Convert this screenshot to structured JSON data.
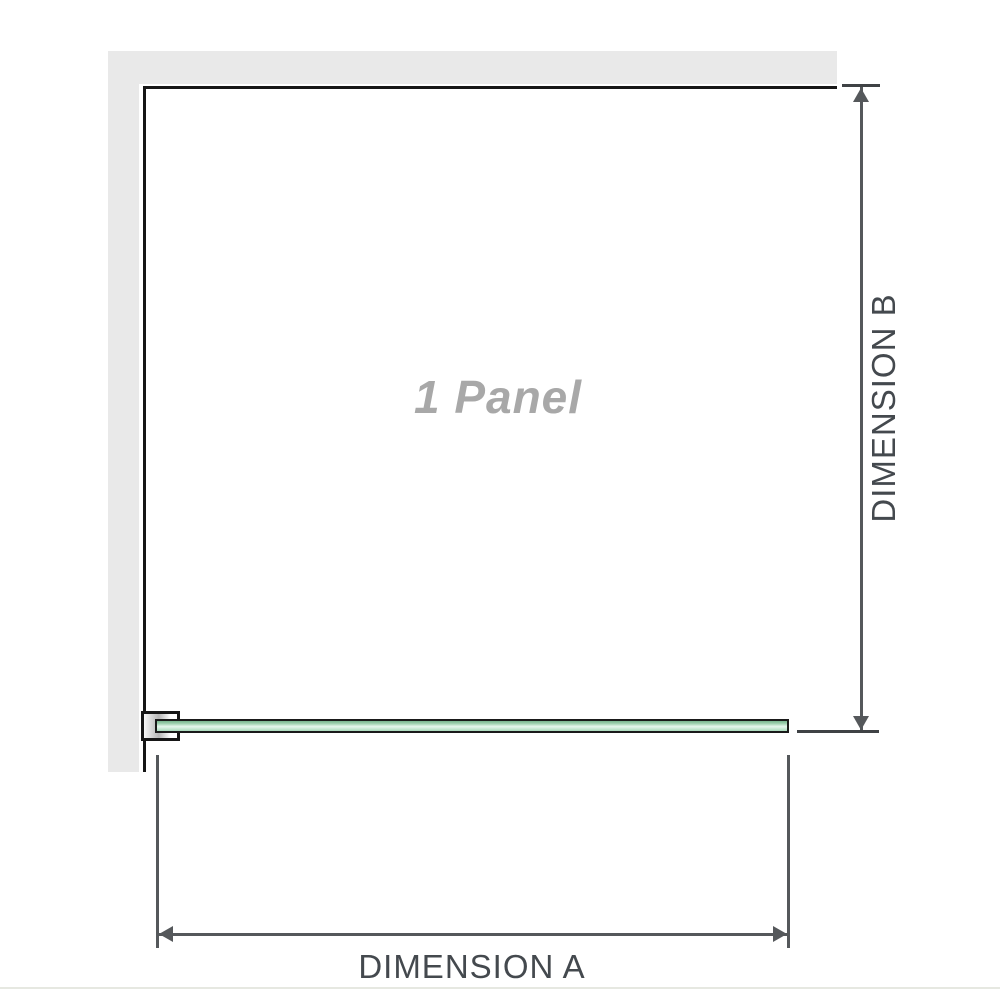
{
  "diagram": {
    "panel_label": "1 Panel",
    "dimension_a": {
      "label": "DIMENSION A"
    },
    "dimension_b": {
      "label": "DIMENSION B"
    },
    "colors": {
      "wall": "#e9e9e9",
      "outline": "#161616",
      "dimension_line": "#55585b",
      "dimension_text": "#44494e",
      "panel_label_text": "#a8a8a8",
      "glass_green_dark": "#79b58f",
      "glass_green_light": "#e7f7ee",
      "bracket_metal": "#b5b5b5",
      "bottom_rule": "#e6e8e1"
    }
  }
}
